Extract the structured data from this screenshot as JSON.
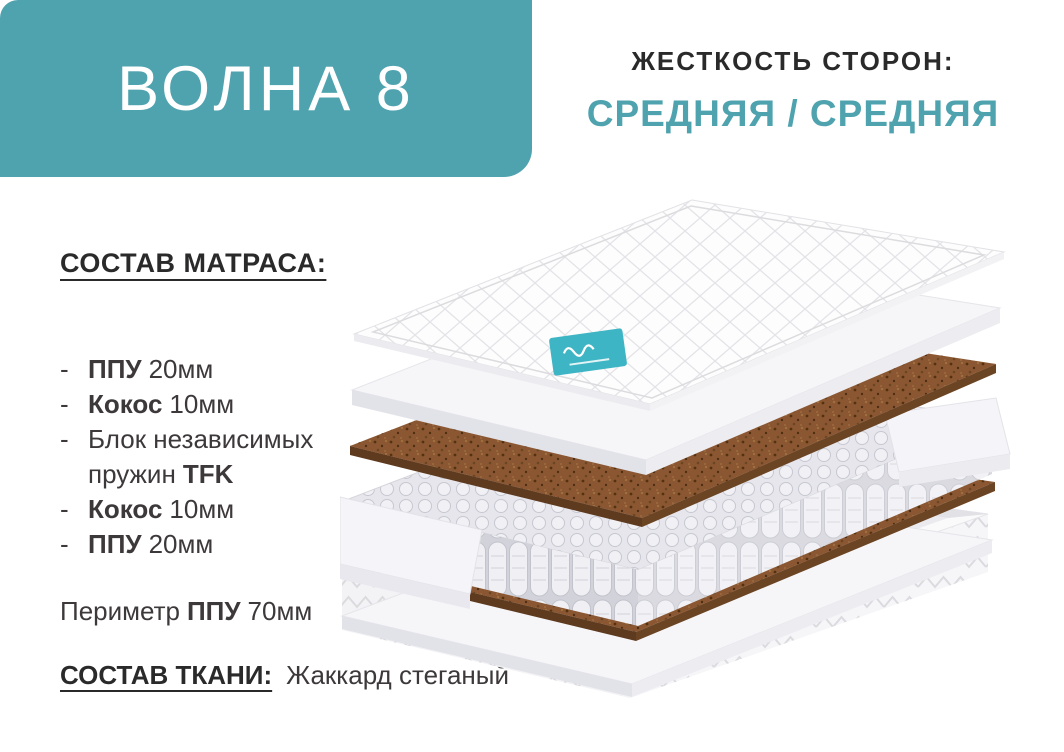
{
  "page": {
    "background": "#ffffff",
    "accent": "#4FA3AF",
    "text_dark": "#2B2A2B",
    "text_body": "#3D393A"
  },
  "banner": {
    "title": "ВОЛНА 8"
  },
  "firmness": {
    "label": "ЖЕСТКОСТЬ СТОРОН:",
    "value": "СРЕДНЯЯ / СРЕДНЯЯ"
  },
  "composition": {
    "heading": "СОСТАВ МАТРАСА:",
    "items": [
      {
        "dash": "-",
        "bold": "ППУ",
        "rest": "20мм"
      },
      {
        "dash": "-",
        "bold": "Кокос",
        "rest": "10мм"
      },
      {
        "dash": "-",
        "pre": "Блок независимых пружин",
        "bold2": "TFK"
      },
      {
        "dash": "-",
        "bold": "Кокос",
        "rest": "10мм"
      },
      {
        "dash": "-",
        "bold": "ППУ",
        "rest": "20мм"
      }
    ],
    "perimeter": {
      "pre": "Периметр",
      "bold": "ППУ",
      "post": "70мм"
    }
  },
  "fabric": {
    "heading": "СОСТАВ ТКАНИ:",
    "value": "Жаккард стеганый"
  },
  "illustration": {
    "colors": {
      "coconut_top": "#8A5732",
      "coconut_edge_left": "#5E3A1F",
      "coconut_edge_right": "#6B4423",
      "foam": "#F6F6F9",
      "brand_tag": "#3EB5C4"
    }
  }
}
